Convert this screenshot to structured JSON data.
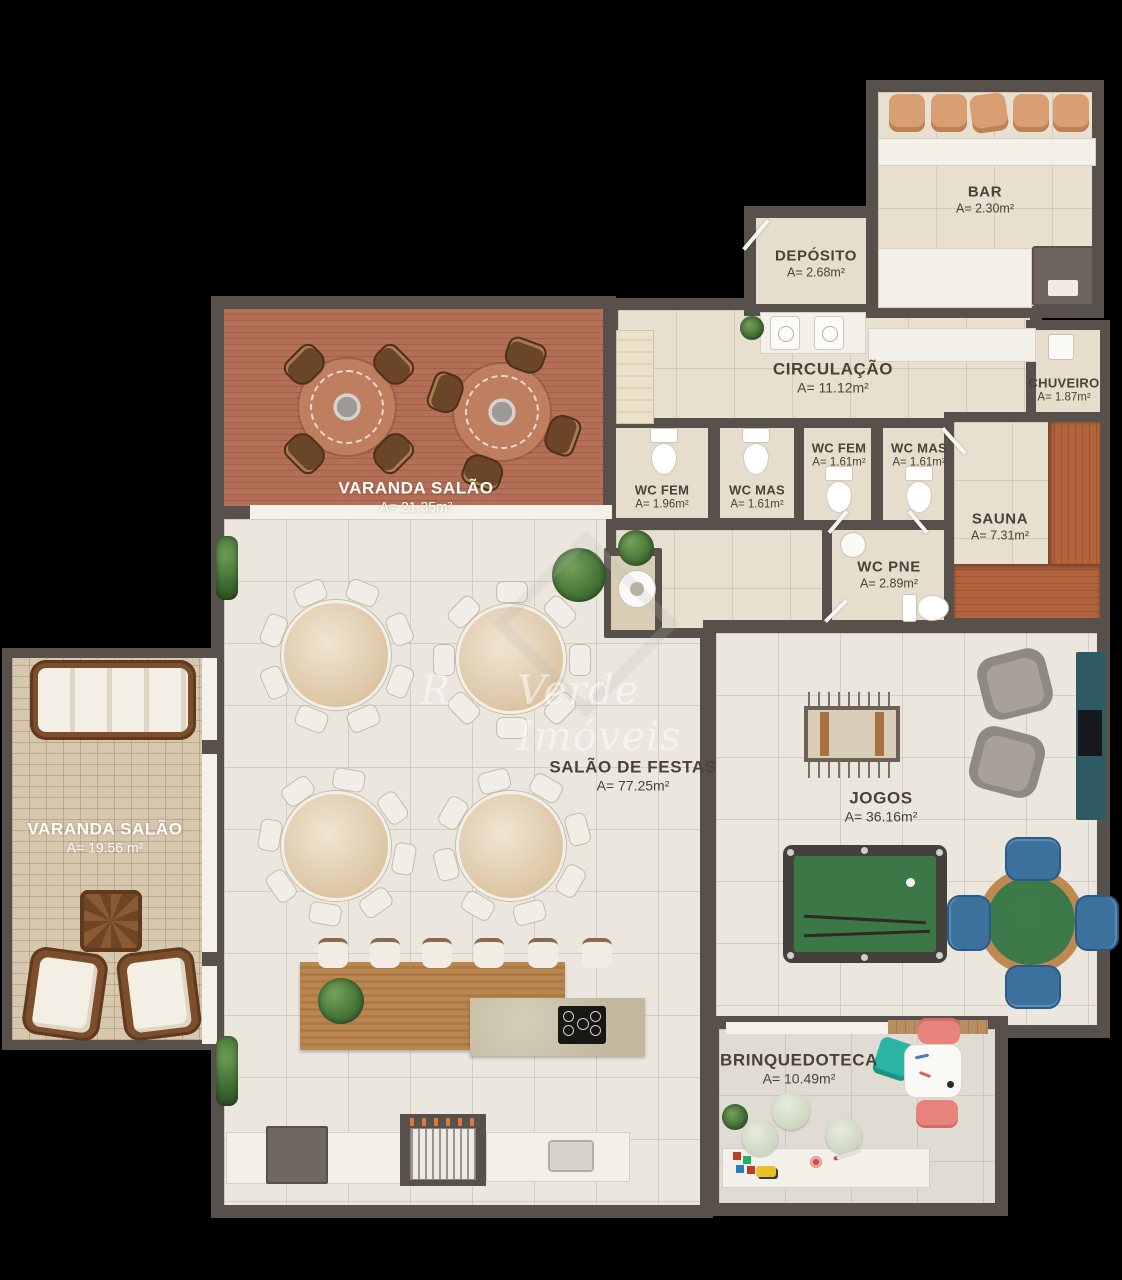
{
  "title": "Floor plan — party hall level",
  "watermark": {
    "fragment": "R",
    "text": "Verde Imóveis",
    "logo": "diamond-house-logo"
  },
  "rooms": {
    "bar": {
      "name": "BAR",
      "area": "A= 2.30m²"
    },
    "deposito": {
      "name": "DEPÓSITO",
      "area": "A= 2.68m²"
    },
    "circulacao": {
      "name": "CIRCULAÇÃO",
      "area": "A= 11.12m²"
    },
    "chuveiro": {
      "name": "CHUVEIRO",
      "area": "A= 1.87m²"
    },
    "wc_fem_small": {
      "name": "WC FEM",
      "area": "A= 1.61m²"
    },
    "wc_mas_small": {
      "name": "WC MAS",
      "area": "A= 1.61m²"
    },
    "wc_fem": {
      "name": "WC FEM",
      "area": "A= 1.96m²"
    },
    "wc_mas": {
      "name": "WC MAS",
      "area": "A= 1.61m²"
    },
    "sauna": {
      "name": "SAUNA",
      "area": "A= 7.31m²"
    },
    "wc_pne": {
      "name": "WC PNE",
      "area": "A= 2.89m²"
    },
    "varanda_top": {
      "name": "VARANDA SALÃO",
      "area": "A= 21.35m²"
    },
    "varanda_left": {
      "name": "VARANDA SALÃO",
      "area": "A= 19.56 m²"
    },
    "salao": {
      "name": "SALÃO DE FESTAS",
      "area": "A= 77.25m²"
    },
    "jogos": {
      "name": "JOGOS",
      "area": "A= 36.16m²"
    },
    "brinquedoteca": {
      "name": "BRINQUEDOTECA",
      "area": "A= 10.49m²"
    }
  },
  "colors": {
    "wall": "#57504b",
    "deck_wood": "#b47057",
    "sauna_wood": "#b2653d",
    "pool_felt": "#3b7747",
    "card_chair_blue": "#3c709d",
    "tv_console_teal": "#2d5a63",
    "kids_teal": "#2ab4a3",
    "kids_pink": "#e8837c"
  }
}
